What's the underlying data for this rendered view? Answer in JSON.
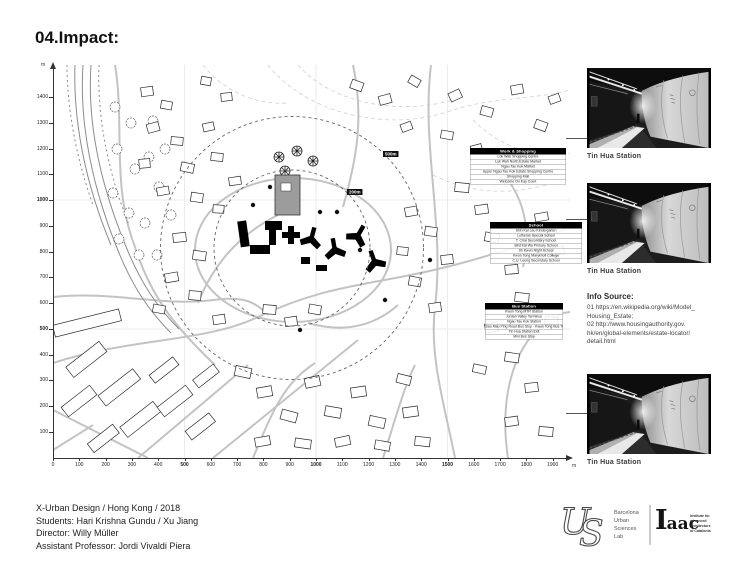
{
  "page": {
    "title": "04.Impact:"
  },
  "map": {
    "unit_label": "m",
    "x_ticks": [
      "0",
      "100",
      "200",
      "300",
      "400",
      "500",
      "600",
      "700",
      "800",
      "900",
      "1000",
      "1100",
      "1200",
      "1300",
      "1400",
      "1500",
      "1600",
      "1700",
      "1800",
      "1900"
    ],
    "x_bold": [
      "500",
      "1000",
      "1500"
    ],
    "y_ticks": [
      "1400",
      "1300",
      "1200",
      "1100",
      "1000",
      "900",
      "800",
      "700",
      "600",
      "500",
      "400",
      "300",
      "200",
      "100"
    ],
    "y_bold": [
      "1000",
      "500"
    ],
    "radius_chips": [
      {
        "label": "500m"
      },
      {
        "label": "200m"
      }
    ],
    "callouts": [
      {
        "header": "Work & Shopping",
        "items": [
          "Lok Wah Shopping Centre",
          "Lok Wah North Estate Market",
          "Ngau Tau Kok Market",
          "Upper Ngau Tau Kok Estate Shopping Centre",
          "Shopping Mall",
          "Welcome On Kay Court"
        ]
      },
      {
        "header": "School",
        "items": [
          "Shin Kai Lau Kindergarten",
          "Lutheran Special School",
          "T. Chai Secondary School",
          "Bird Kai Wa Primary School",
          "Sh Kwun Night School",
          "Kwun Tong Maryknoll College",
          "C.U. Leung Secondary School"
        ]
      },
      {
        "header": "Bus Station",
        "items": [
          "Kwun Tong MTR Station",
          "Jordan Valley Terminus",
          "Ngau Tau Kok Station",
          "Sau Mau Ping Road Bus Stop - Kwun Tong Bus Terminus",
          "Tin Hua Station Exit",
          "Mini Bus Stop"
        ]
      }
    ]
  },
  "photos": [
    {
      "caption": "Tin Hua Station"
    },
    {
      "caption": "Tin Hua Station"
    },
    {
      "caption": "Tin Hua Station"
    }
  ],
  "info_source": {
    "heading": "Info Source:",
    "lines": [
      "01  https://en.wikipedia.org/wiki/Model_",
      "Housing_Estate;",
      "02  http://www.housingauthority.gov.",
      "hk/en/global-elements/estate-locator/",
      "detail.html"
    ]
  },
  "credits": {
    "line1": "X-Urban Design / Hong Kong / 2018",
    "line2": "Students: Hari Krishna Gundu / Xu Jiang",
    "line3": "Director: Willy Müller",
    "line4": "Assistant Professor: Jordi Vivaldi Piera"
  },
  "logos": {
    "usl": {
      "monogram_u": "U",
      "monogram_s": "S",
      "lines": [
        "Barcelona",
        "Urban",
        "Sciences",
        "Lab"
      ]
    },
    "iaac": {
      "wordmark_initial": "I",
      "wordmark_rest": "aac",
      "lines": [
        "Institute for",
        "advanced",
        "architecture",
        "of Catalonia"
      ]
    }
  }
}
